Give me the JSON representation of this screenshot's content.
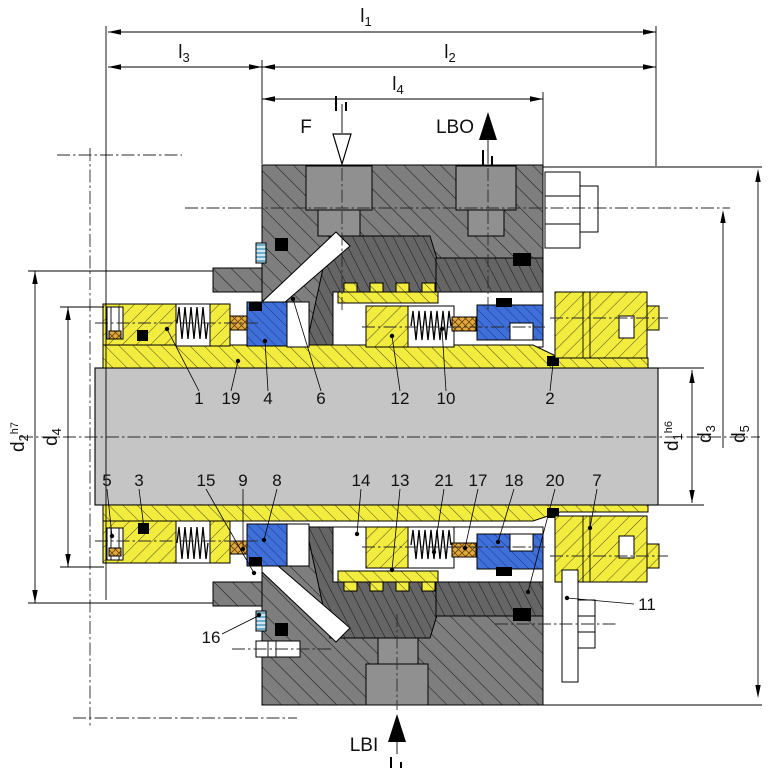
{
  "dims": {
    "l1": {
      "base": "l",
      "sub": "1"
    },
    "l2": {
      "base": "l",
      "sub": "2"
    },
    "l3": {
      "base": "l",
      "sub": "3"
    },
    "l4": {
      "base": "l",
      "sub": "4"
    },
    "d1": {
      "base": "d",
      "sub": "1",
      "tol": "h6"
    },
    "d2": {
      "base": "d",
      "sub": "2",
      "tol": "h7"
    },
    "d3": {
      "base": "d",
      "sub": "3"
    },
    "d4": {
      "base": "d",
      "sub": "4"
    },
    "d5": {
      "base": "d",
      "sub": "5"
    }
  },
  "ports": {
    "flush": "F",
    "barrier_out": "LBO",
    "barrier_in": "LBI"
  },
  "callouts": {
    "upper": [
      "1",
      "19",
      "4",
      "6",
      "12",
      "10",
      "2"
    ],
    "lower": [
      "5",
      "3",
      "15",
      "9",
      "8",
      "14",
      "13",
      "21",
      "17",
      "18",
      "20",
      "7"
    ],
    "gland_gasket": "16",
    "gland_plate": "11"
  },
  "colors": {
    "part_yellow": "#f2ec3e",
    "part_blue": "#3f6fd8",
    "packing_tan": "#e2aa3e",
    "housing_gray": "#7e7e7e",
    "housing_dark_gray": "#646464",
    "shaft_gray": "#c5c5c5",
    "bore_gray": "#909090",
    "gasket_stripe": "#2e86ad"
  }
}
